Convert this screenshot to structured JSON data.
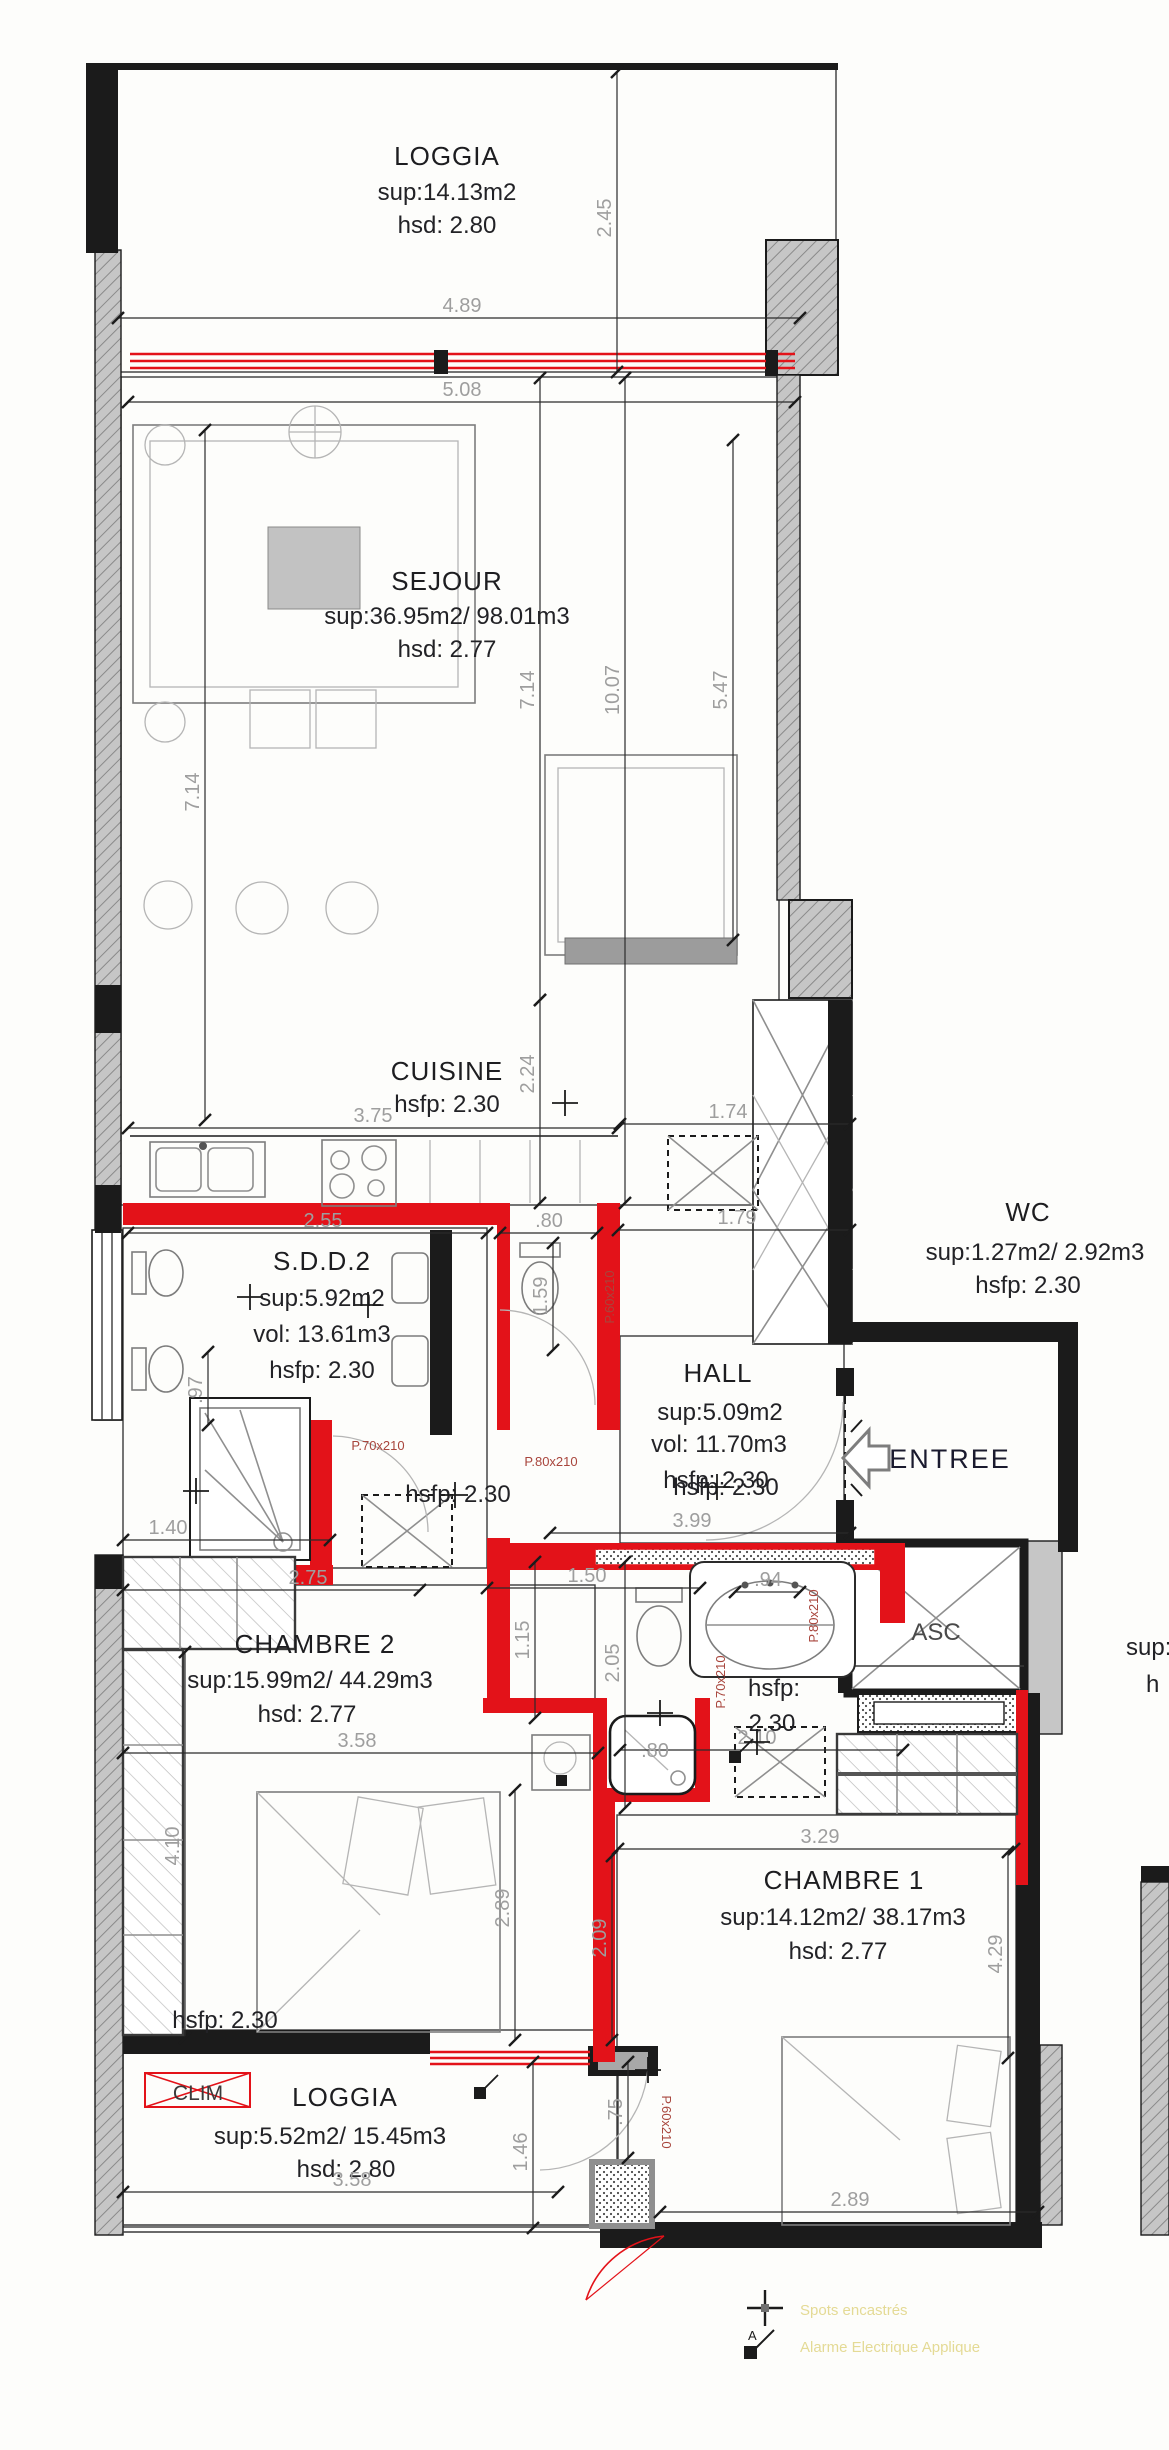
{
  "colors": {
    "wall": "#1b1b1b",
    "new_partition_red": "#e31219",
    "existing_wall_gray": "#c6c6c6",
    "dimension_gray": "#9e9e9e",
    "legend_yellow": "#ded27c"
  },
  "rooms": {
    "loggia_top": {
      "name": "LOGGIA",
      "area": "sup:14.13m2",
      "height": "hsd: 2.80"
    },
    "sejour": {
      "name": "SEJOUR",
      "area": "sup:36.95m2/ 98.01m3",
      "height": "hsd: 2.77"
    },
    "cuisine": {
      "name": "CUISINE",
      "height": "hsfp: 2.30"
    },
    "sdd2": {
      "name": "S.D.D.2",
      "area": "sup:5.92m2",
      "volume": "vol: 13.61m3",
      "height": "hsfp: 2.30"
    },
    "wc": {
      "name": "WC",
      "area": "sup:1.27m2/ 2.92m3",
      "height": "hsfp: 2.30"
    },
    "hall": {
      "name": "HALL",
      "area": "sup:5.09m2",
      "volume": "vol: 11.70m3",
      "height": "hsfp: 2.30"
    },
    "chambre2": {
      "name": "CHAMBRE 2",
      "area": "sup:15.99m2/ 44.29m3",
      "height": "hsd: 2.77"
    },
    "chambre1": {
      "name": "CHAMBRE 1",
      "area": "sup:14.12m2/ 38.17m3",
      "height": "hsd: 2.77"
    },
    "loggia_bottom": {
      "name": "LOGGIA",
      "area": "sup:5.52m2/ 15.45m3",
      "height": "hsd: 2.80"
    },
    "asc": {
      "name": "ASC"
    },
    "clim": {
      "name": "CLIM"
    },
    "entree": {
      "name": "ENTREE"
    },
    "right_cut": {
      "line1": "sup:2",
      "line2": "h"
    }
  },
  "floating_labels": [
    {
      "t": "hsfp: 2.30",
      "x": 458,
      "y": 1502
    },
    {
      "t": "hsfp: 2.30",
      "x": 726,
      "y": 1495
    },
    {
      "t": "hsfp:",
      "x": 774,
      "y": 1696
    },
    {
      "t": "2.30",
      "x": 772,
      "y": 1731
    },
    {
      "t": "hsfp: 2.30",
      "x": 225,
      "y": 2028
    }
  ],
  "dimensions": [
    {
      "t": "4.89",
      "x1": 118,
      "y1": 318,
      "x2": 800,
      "y2": 318,
      "lx": 462,
      "ly": 312,
      "r": 0
    },
    {
      "t": "5.08",
      "x1": 128,
      "y1": 402,
      "x2": 795,
      "y2": 402,
      "lx": 462,
      "ly": 396,
      "r": 0
    },
    {
      "t": "2.45",
      "x1": 617,
      "y1": 72,
      "x2": 617,
      "y2": 372,
      "lx": 611,
      "ly": 218,
      "r": -90
    },
    {
      "t": "7.14",
      "x1": 205,
      "y1": 430,
      "x2": 205,
      "y2": 1120,
      "lx": 199,
      "ly": 792,
      "r": -90
    },
    {
      "t": "7.14",
      "x1": 540,
      "y1": 378,
      "x2": 540,
      "y2": 1000,
      "lx": 534,
      "ly": 690,
      "r": -90
    },
    {
      "t": "10.07",
      "x1": 625,
      "y1": 378,
      "x2": 625,
      "y2": 1203,
      "lx": 619,
      "ly": 690,
      "r": -90
    },
    {
      "t": "5.47",
      "x1": 733,
      "y1": 440,
      "x2": 733,
      "y2": 940,
      "lx": 727,
      "ly": 690,
      "r": -90
    },
    {
      "t": "2.24",
      "x1": 540,
      "y1": 1000,
      "x2": 540,
      "y2": 1203,
      "lx": 534,
      "ly": 1074,
      "r": -90
    },
    {
      "t": "3.75",
      "x1": 128,
      "y1": 1128,
      "x2": 618,
      "y2": 1128,
      "lx": 373,
      "ly": 1122,
      "r": 0
    },
    {
      "t": "1.74",
      "x1": 620,
      "y1": 1124,
      "x2": 850,
      "y2": 1124,
      "lx": 728,
      "ly": 1118,
      "r": 0
    },
    {
      "t": "2.55",
      "x1": 128,
      "y1": 1233,
      "x2": 487,
      "y2": 1233,
      "lx": 323,
      "ly": 1227,
      "r": 0
    },
    {
      "t": "1.79",
      "x1": 618,
      "y1": 1230,
      "x2": 850,
      "y2": 1230,
      "lx": 737,
      "ly": 1224,
      "r": 0
    },
    {
      "t": ".80",
      "x1": 500,
      "y1": 1233,
      "x2": 597,
      "y2": 1233,
      "lx": 549,
      "ly": 1227,
      "r": 0
    },
    {
      "t": "1.59",
      "x1": 553,
      "y1": 1243,
      "x2": 553,
      "y2": 1350,
      "lx": 547,
      "ly": 1296,
      "r": -90
    },
    {
      "t": "3.99",
      "x1": 550,
      "y1": 1533,
      "x2": 850,
      "y2": 1533,
      "lx": 692,
      "ly": 1527,
      "r": 0
    },
    {
      "t": "1.40",
      "x1": 123,
      "y1": 1540,
      "x2": 330,
      "y2": 1540,
      "lx": 168,
      "ly": 1534,
      "r": 0
    },
    {
      "t": ".97",
      "x1": 208,
      "y1": 1352,
      "x2": 208,
      "y2": 1425,
      "lx": 202,
      "ly": 1390,
      "r": -90
    },
    {
      "t": "2.75",
      "x1": 123,
      "y1": 1590,
      "x2": 420,
      "y2": 1590,
      "lx": 308,
      "ly": 1584,
      "r": 0
    },
    {
      "t": "1.50",
      "x1": 487,
      "y1": 1588,
      "x2": 700,
      "y2": 1588,
      "lx": 587,
      "ly": 1582,
      "r": 0
    },
    {
      "t": ".94",
      "x1": 735,
      "y1": 1592,
      "x2": 800,
      "y2": 1592,
      "lx": 768,
      "ly": 1586,
      "r": 0
    },
    {
      "t": "1.15",
      "x1": 535,
      "y1": 1562,
      "x2": 535,
      "y2": 1718,
      "lx": 529,
      "ly": 1640,
      "r": -90
    },
    {
      "t": "2.05",
      "x1": 625,
      "y1": 1562,
      "x2": 625,
      "y2": 1808,
      "lx": 619,
      "ly": 1663,
      "r": -90
    },
    {
      "t": "3.58",
      "x1": 123,
      "y1": 1753,
      "x2": 598,
      "y2": 1753,
      "lx": 357,
      "ly": 1747,
      "r": 0
    },
    {
      "t": "2.10",
      "x1": 620,
      "y1": 1750,
      "x2": 903,
      "y2": 1750,
      "lx": 757,
      "ly": 1744,
      "r": 0
    },
    {
      "t": ".80",
      "lx": 655,
      "ly": 1757,
      "r": 0
    },
    {
      "t": "3.29",
      "x1": 618,
      "y1": 1849,
      "x2": 1014,
      "y2": 1849,
      "lx": 820,
      "ly": 1843,
      "r": 0
    },
    {
      "t": "2.89",
      "x1": 515,
      "y1": 1790,
      "x2": 515,
      "y2": 2040,
      "lx": 509,
      "ly": 1908,
      "r": -90
    },
    {
      "t": "2.09",
      "x1": 612,
      "y1": 1856,
      "x2": 612,
      "y2": 2040,
      "lx": 606,
      "ly": 1938,
      "r": -90
    },
    {
      "t": "4.10",
      "x1": 185,
      "y1": 1652,
      "x2": 185,
      "y2": 2038,
      "lx": 179,
      "ly": 1846,
      "r": -90
    },
    {
      "t": "4.29",
      "x1": 1008,
      "y1": 1852,
      "x2": 1008,
      "y2": 2058,
      "lx": 1002,
      "ly": 1954,
      "r": -90
    },
    {
      "t": "1.46",
      "x1": 533,
      "y1": 2062,
      "x2": 533,
      "y2": 2228,
      "lx": 527,
      "ly": 2152,
      "r": -90
    },
    {
      "t": ".75",
      "x1": 628,
      "y1": 2062,
      "x2": 628,
      "y2": 2158,
      "lx": 622,
      "ly": 2112,
      "r": -90
    },
    {
      "t": "3.58",
      "x1": 123,
      "y1": 2192,
      "x2": 558,
      "y2": 2192,
      "lx": 352,
      "ly": 2186,
      "r": 0
    },
    {
      "t": "2.89",
      "x1": 660,
      "y1": 2212,
      "x2": 1038,
      "y2": 2212,
      "lx": 850,
      "ly": 2206,
      "r": 0
    }
  ],
  "door_labels": [
    {
      "t": "P.70x210",
      "x": 378,
      "y": 1450,
      "r": 0
    },
    {
      "t": "P.80x210",
      "x": 551,
      "y": 1466,
      "r": 0
    },
    {
      "t": "P.60x210",
      "x": 614,
      "y": 1297,
      "r": -90
    },
    {
      "t": "P.80x210",
      "x": 818,
      "y": 1616,
      "r": -90
    },
    {
      "t": "P.70x210",
      "x": 725,
      "y": 1682,
      "r": -90
    },
    {
      "t": "P.60x210",
      "x": 662,
      "y": 2122,
      "r": 90
    }
  ],
  "spots": [
    [
      565,
      1103
    ],
    [
      250,
      1297
    ],
    [
      368,
      1305
    ],
    [
      196,
      1491
    ],
    [
      455,
      1495
    ],
    [
      717,
      1487
    ],
    [
      660,
      1713
    ],
    [
      757,
      1742
    ],
    [
      648,
      2070
    ]
  ],
  "alarm_markers": [
    [
      480,
      2093
    ],
    [
      735,
      1757
    ]
  ],
  "legend": {
    "items": [
      {
        "icon": "spot-cross-icon",
        "label": "Spots encastrés"
      },
      {
        "icon": "alarm-icon",
        "label": "Alarme Electrique Applique"
      }
    ]
  }
}
